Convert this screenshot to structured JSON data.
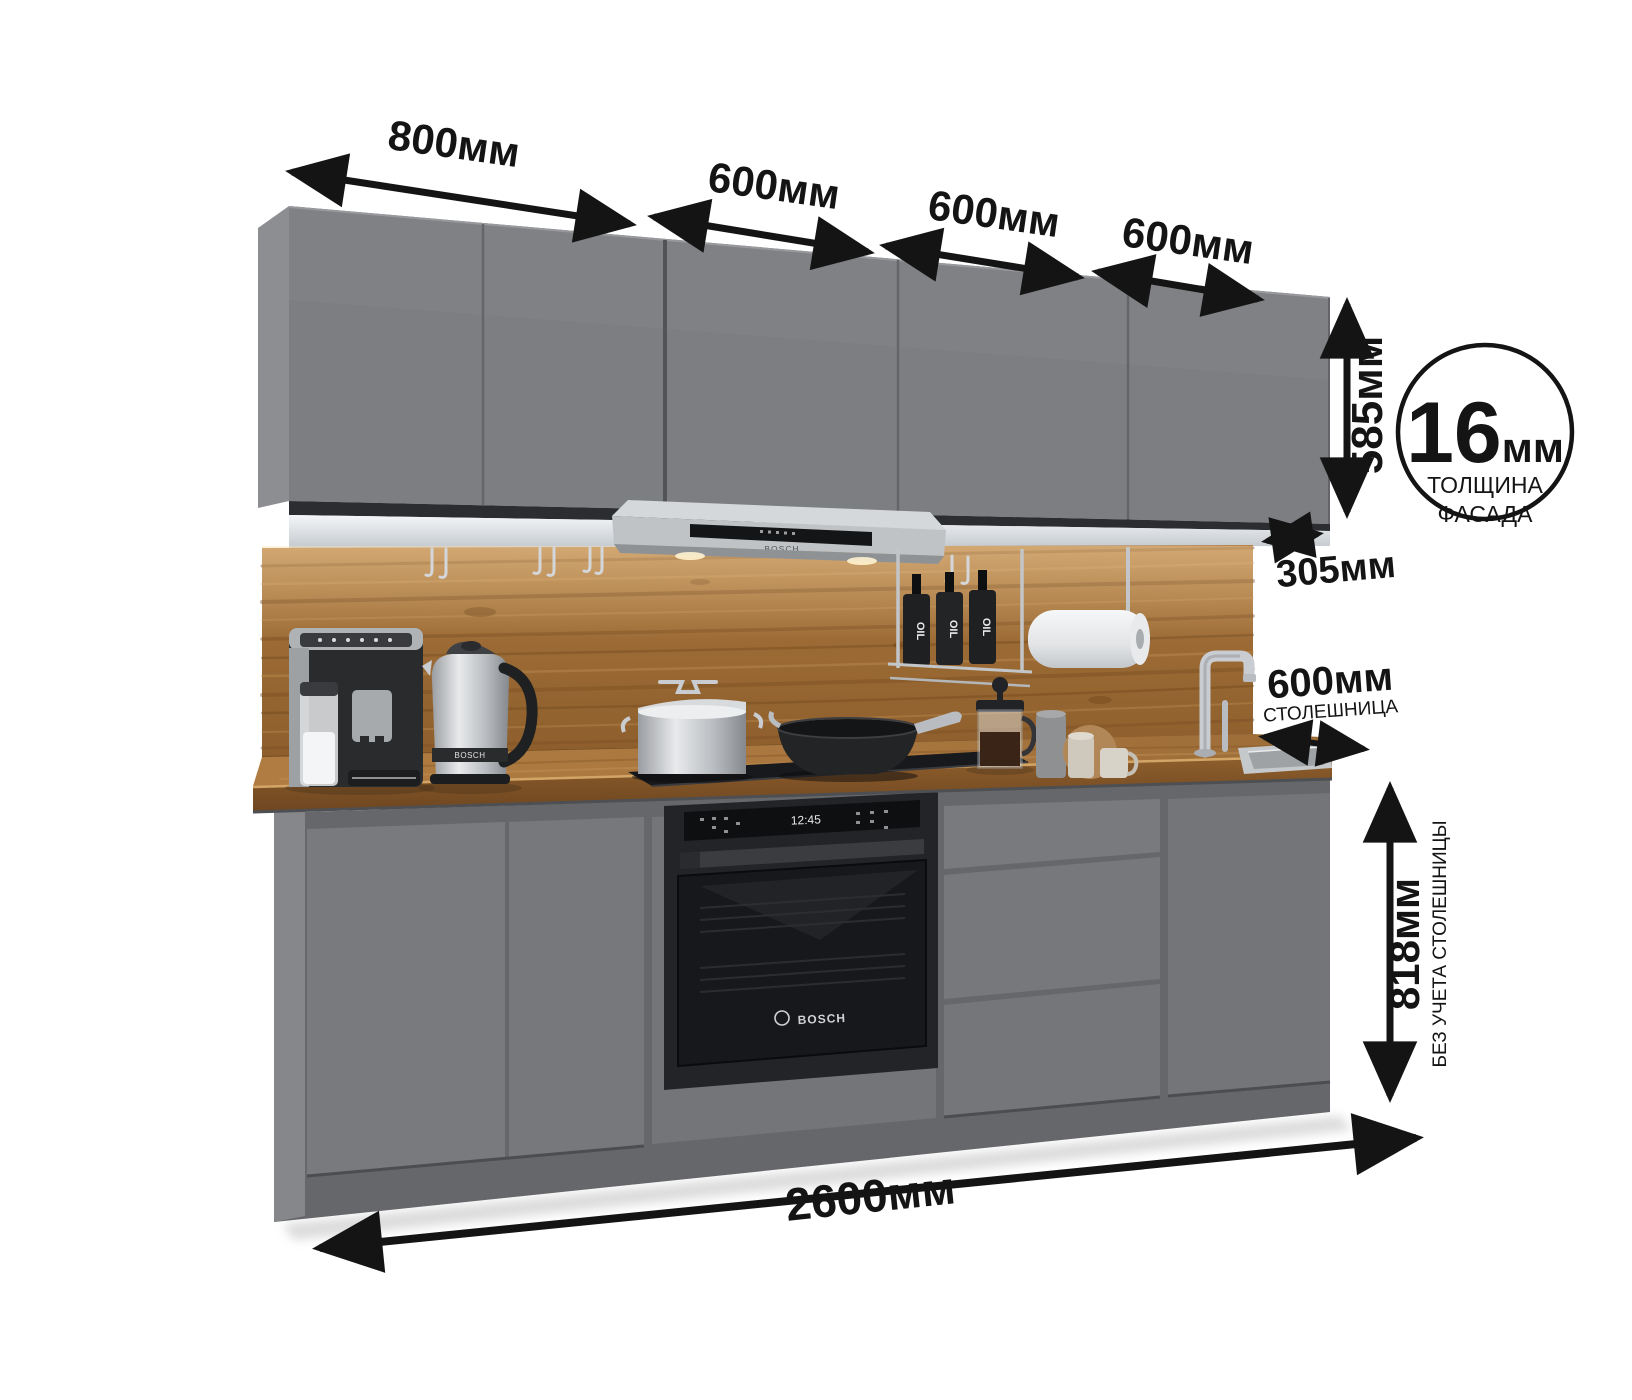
{
  "meta": {
    "description": "Kitchen set product render with dimension callouts",
    "language": "ru"
  },
  "dims": {
    "widths": [
      "800мм",
      "600мм",
      "600мм",
      "600мм"
    ],
    "upper_height": "585мм",
    "upper_depth": "305мм",
    "counter_depth_value": "600мм",
    "counter_depth_label": "СТОЛЕШНИЦА",
    "base_height_value": "818мм",
    "base_height_label": "БЕЗ УЧЕТА СТОЛЕШНИЦЫ",
    "total_width": "2600мм",
    "facade_thickness_value": "16",
    "facade_thickness_unit": "мм",
    "facade_thickness_label_1": "ТОЛЩИНА",
    "facade_thickness_label_2": "ФАСАДА"
  },
  "appliances": {
    "oven_brand": "BOSCH",
    "oven_clock": "12:45",
    "hood_brand": "BOSCH",
    "kettle_brand": "BOSCH",
    "oil_bottle_label": "OIL"
  },
  "colors": {
    "background": "#ffffff",
    "cabinet_front": "#7d7e81",
    "cabinet_side": "#8c8e91",
    "cabinet_carcass": "#66676a",
    "wood_backsplash": "#9c6b35",
    "wood_countertop": "#a9773f",
    "light_panel": "#e9edf0",
    "annotation": "#141414",
    "appliance_black": "#1a1b1e",
    "steel": "#c9ccd0"
  }
}
